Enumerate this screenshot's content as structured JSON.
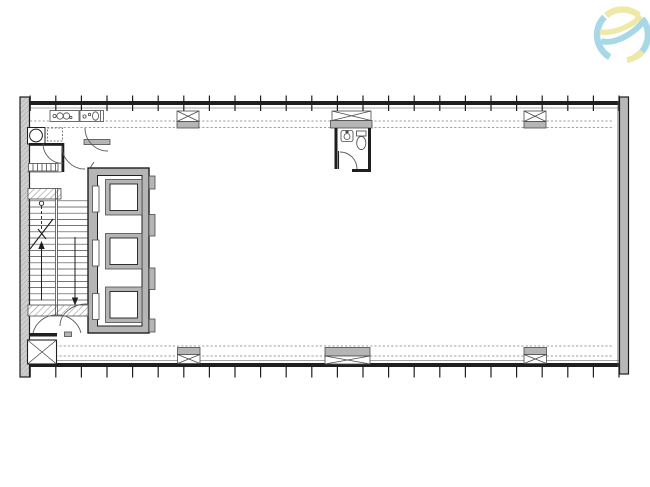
{
  "page": {
    "title": "floor-plan-drawing",
    "background": "#ffffff"
  },
  "logo": {
    "id": "sphere-swoosh-logo",
    "colors": {
      "blue": "#a8d8e6",
      "yellow": "#efe9a8"
    }
  },
  "plan": {
    "drawing_type": "architectural-floor-plan",
    "colors": {
      "line_dark": "#1f1f1f",
      "line_mid": "#4a4a4a",
      "line_light": "#8a8a8a",
      "wall_gray": "#b5b5b5",
      "wall_cut": "#cfcfcf",
      "hatch_line": "#8f8f8f"
    },
    "curtain_wall": {
      "mullion_count_top": 24,
      "mullion_count_bottom": 24
    },
    "stair": {
      "flights": 2,
      "steps_per_flight": 17,
      "direction_arrows": [
        "up",
        "down"
      ]
    },
    "elevators": {
      "count": 3
    },
    "columns": {
      "top": 2,
      "bottom": 4
    },
    "rooms": {
      "toilet_top_left": {
        "fixtures": [
          "basin",
          "basin",
          "wc",
          "radiator",
          "appliance"
        ]
      },
      "wc_mid": {
        "fixtures": [
          "basin",
          "toilet"
        ]
      }
    }
  }
}
